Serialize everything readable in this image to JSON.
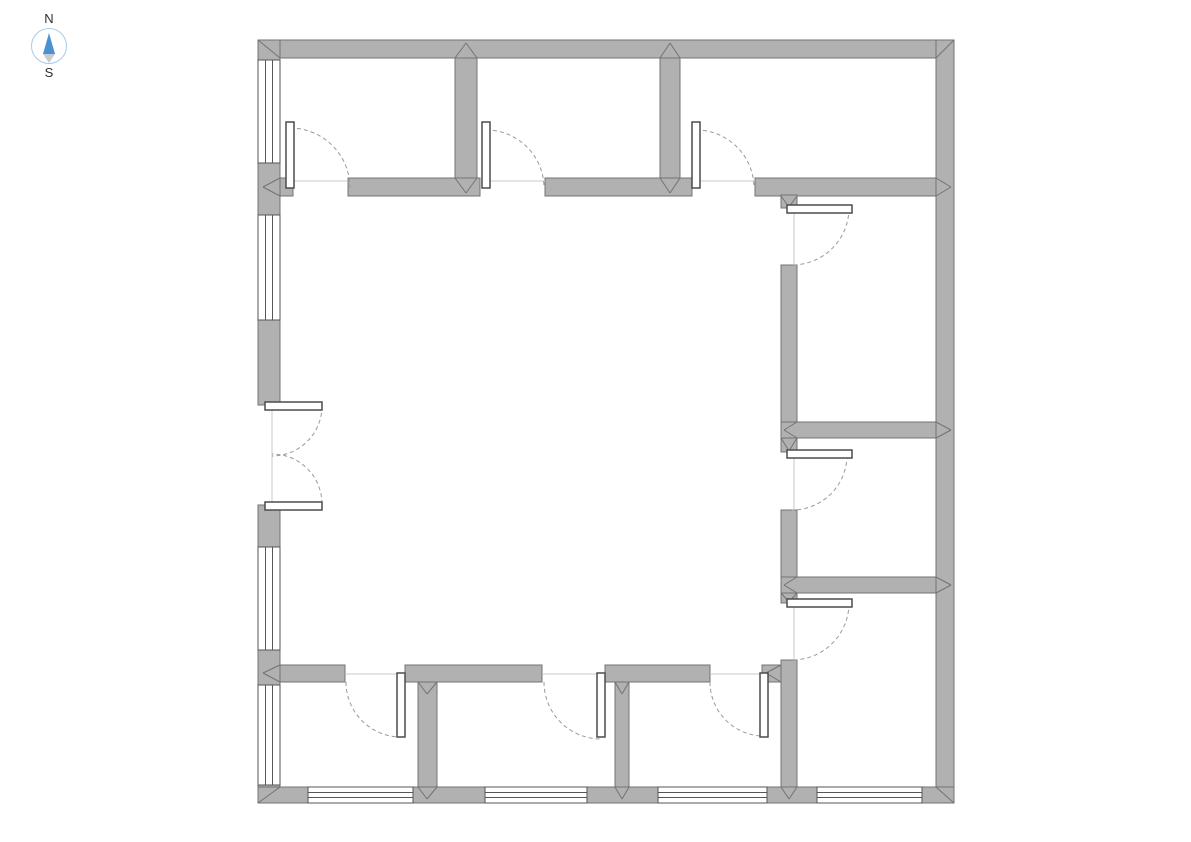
{
  "canvas": {
    "width": 1191,
    "height": 842,
    "background": "#ffffff"
  },
  "compass": {
    "north_label": "N",
    "south_label": "S"
  },
  "palette": {
    "wall_fill": "#b1b1b1",
    "wall_stroke": "#737373",
    "window_line": "#565656",
    "window_fill": "#ffffff",
    "leaf_fill": "#ffffff",
    "leaf_stroke": "#4c4c4c",
    "arc_color": "#9a9a9a",
    "opening_line": "#c8c8c8",
    "compass_circle": "#a9cbe5",
    "compass_north": "#4a90d2",
    "compass_south": "#c7ccd1"
  },
  "plan": {
    "walls": [
      [
        258,
        40,
        696,
        18
      ],
      [
        258,
        40,
        22,
        20
      ],
      [
        258,
        163,
        22,
        52
      ],
      [
        258,
        320,
        22,
        85
      ],
      [
        258,
        505,
        22,
        42
      ],
      [
        258,
        650,
        22,
        35
      ],
      [
        258,
        785,
        22,
        18
      ],
      [
        936,
        40,
        18,
        763
      ],
      [
        258,
        787,
        50,
        16
      ],
      [
        413,
        787,
        72,
        16
      ],
      [
        587,
        787,
        71,
        16
      ],
      [
        767,
        787,
        50,
        16
      ],
      [
        922,
        787,
        32,
        16
      ],
      [
        280,
        178,
        13,
        18
      ],
      [
        348,
        178,
        132,
        18
      ],
      [
        545,
        178,
        147,
        18
      ],
      [
        755,
        178,
        181,
        18
      ],
      [
        455,
        58,
        22,
        120
      ],
      [
        660,
        58,
        20,
        120
      ],
      [
        781,
        195,
        16,
        13
      ],
      [
        781,
        265,
        16,
        173
      ],
      [
        781,
        438,
        16,
        14
      ],
      [
        781,
        510,
        16,
        67
      ],
      [
        781,
        593,
        16,
        10
      ],
      [
        781,
        660,
        16,
        127
      ],
      [
        781,
        422,
        155,
        16
      ],
      [
        781,
        577,
        155,
        16
      ],
      [
        280,
        665,
        65,
        17
      ],
      [
        405,
        665,
        137,
        17
      ],
      [
        605,
        665,
        105,
        17
      ],
      [
        762,
        665,
        19,
        17
      ],
      [
        418,
        682,
        19,
        105
      ],
      [
        615,
        682,
        14,
        105
      ]
    ],
    "windows": [
      {
        "x": 258,
        "y": 60,
        "w": 22,
        "h": 103,
        "dir": "v"
      },
      {
        "x": 258,
        "y": 215,
        "w": 22,
        "h": 105,
        "dir": "v"
      },
      {
        "x": 258,
        "y": 547,
        "w": 22,
        "h": 103,
        "dir": "v"
      },
      {
        "x": 258,
        "y": 685,
        "w": 22,
        "h": 100,
        "dir": "v"
      },
      {
        "x": 308,
        "y": 787,
        "w": 105,
        "h": 16,
        "dir": "h"
      },
      {
        "x": 485,
        "y": 787,
        "w": 102,
        "h": 16,
        "dir": "h"
      },
      {
        "x": 658,
        "y": 787,
        "w": 109,
        "h": 16,
        "dir": "h"
      },
      {
        "x": 817,
        "y": 787,
        "w": 105,
        "h": 16,
        "dir": "h"
      }
    ],
    "door_leaves": [
      [
        286,
        122,
        8,
        66
      ],
      [
        482,
        122,
        8,
        66
      ],
      [
        692,
        122,
        8,
        66
      ],
      [
        787,
        205,
        65,
        8
      ],
      [
        787,
        450,
        65,
        8
      ],
      [
        787,
        599,
        65,
        8
      ],
      [
        397,
        673,
        8,
        64
      ],
      [
        597,
        673,
        8,
        64
      ],
      [
        760,
        673,
        8,
        64
      ],
      [
        265,
        402,
        57,
        8
      ],
      [
        265,
        502,
        57,
        8
      ]
    ],
    "door_arcs": [
      {
        "hx": 290,
        "hy": 188,
        "r": 60,
        "a0": -90,
        "a1": 0,
        "sweep": 1
      },
      {
        "hx": 486,
        "hy": 188,
        "r": 58,
        "a0": -90,
        "a1": 0,
        "sweep": 1
      },
      {
        "hx": 696,
        "hy": 188,
        "r": 58,
        "a0": -90,
        "a1": 0,
        "sweep": 1
      },
      {
        "hx": 792,
        "hy": 208,
        "r": 57,
        "a0": 0,
        "a1": 90,
        "sweep": 1
      },
      {
        "hx": 792,
        "hy": 455,
        "r": 55,
        "a0": 0,
        "a1": 90,
        "sweep": 1
      },
      {
        "hx": 792,
        "hy": 603,
        "r": 57,
        "a0": 0,
        "a1": 90,
        "sweep": 1
      },
      {
        "hx": 401,
        "hy": 682,
        "r": 55,
        "a0": 180,
        "a1": 90,
        "sweep": 0
      },
      {
        "hx": 601,
        "hy": 682,
        "r": 57,
        "a0": 180,
        "a1": 90,
        "sweep": 0
      },
      {
        "hx": 764,
        "hy": 682,
        "r": 54,
        "a0": 180,
        "a1": 90,
        "sweep": 0
      },
      {
        "hx": 272,
        "hy": 406,
        "r": 50,
        "a0": 0,
        "a1": 90,
        "sweep": 1
      },
      {
        "hx": 272,
        "hy": 504,
        "r": 50,
        "a0": 0,
        "a1": -90,
        "sweep": 0
      }
    ],
    "opening_lines": [
      [
        294,
        181,
        348,
        181
      ],
      [
        490,
        181,
        545,
        181
      ],
      [
        700,
        181,
        755,
        181
      ],
      [
        794,
        208,
        794,
        265
      ],
      [
        794,
        458,
        794,
        510
      ],
      [
        794,
        607,
        794,
        660
      ],
      [
        345,
        674,
        397,
        674
      ],
      [
        542,
        674,
        597,
        674
      ],
      [
        710,
        674,
        760,
        674
      ],
      [
        272,
        406,
        272,
        504
      ]
    ],
    "miters": [
      [
        258,
        40,
        280,
        58
      ],
      [
        954,
        40,
        936,
        58
      ],
      [
        258,
        803,
        280,
        787
      ],
      [
        954,
        803,
        936,
        787
      ],
      [
        455,
        58,
        466,
        43
      ],
      [
        477,
        58,
        466,
        43
      ],
      [
        660,
        58,
        670,
        43
      ],
      [
        680,
        58,
        670,
        43
      ],
      [
        455,
        178,
        466,
        193
      ],
      [
        477,
        178,
        466,
        193
      ],
      [
        660,
        178,
        670,
        193
      ],
      [
        680,
        178,
        670,
        193
      ],
      [
        280,
        178,
        263,
        187
      ],
      [
        280,
        196,
        263,
        187
      ],
      [
        936,
        178,
        951,
        187
      ],
      [
        936,
        196,
        951,
        187
      ],
      [
        936,
        422,
        951,
        430
      ],
      [
        936,
        438,
        951,
        430
      ],
      [
        936,
        577,
        951,
        585
      ],
      [
        936,
        593,
        951,
        585
      ],
      [
        280,
        665,
        263,
        673
      ],
      [
        280,
        682,
        263,
        673
      ],
      [
        781,
        196,
        789,
        207
      ],
      [
        797,
        196,
        789,
        207
      ],
      [
        781,
        438,
        789,
        451
      ],
      [
        797,
        438,
        789,
        451
      ],
      [
        781,
        593,
        789,
        602
      ],
      [
        797,
        593,
        789,
        602
      ],
      [
        781,
        665,
        766,
        673
      ],
      [
        781,
        682,
        766,
        673
      ],
      [
        797,
        422,
        784,
        430
      ],
      [
        797,
        438,
        784,
        430
      ],
      [
        797,
        577,
        784,
        585
      ],
      [
        797,
        593,
        784,
        585
      ],
      [
        418,
        682,
        427,
        694
      ],
      [
        437,
        682,
        427,
        694
      ],
      [
        615,
        682,
        622,
        694
      ],
      [
        629,
        682,
        622,
        694
      ],
      [
        418,
        787,
        427,
        799
      ],
      [
        437,
        787,
        427,
        799
      ],
      [
        615,
        787,
        622,
        799
      ],
      [
        629,
        787,
        622,
        799
      ],
      [
        781,
        787,
        789,
        799
      ],
      [
        797,
        787,
        789,
        799
      ]
    ]
  }
}
